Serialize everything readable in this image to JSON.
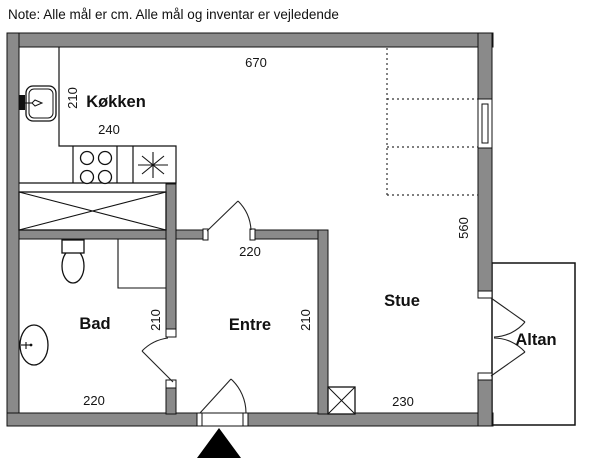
{
  "note": "Note: Alle mål er cm. Alle mål og inventar er vejledende",
  "dims": {
    "top_width": "670"
  },
  "rooms": {
    "kitchen": {
      "name": "Køkken",
      "width": "240",
      "depth": "210"
    },
    "bath": {
      "name": "Bad",
      "width": "220",
      "depth": "210"
    },
    "hall": {
      "name": "Entre",
      "width": "220",
      "depth": "210"
    },
    "living": {
      "name": "Stue",
      "width": "230",
      "depth": "560"
    },
    "balcony": {
      "name": "Altan"
    }
  },
  "colors": {
    "wall": "#8a8a8a",
    "line": "#000000",
    "entrance_marker": "#000000"
  }
}
